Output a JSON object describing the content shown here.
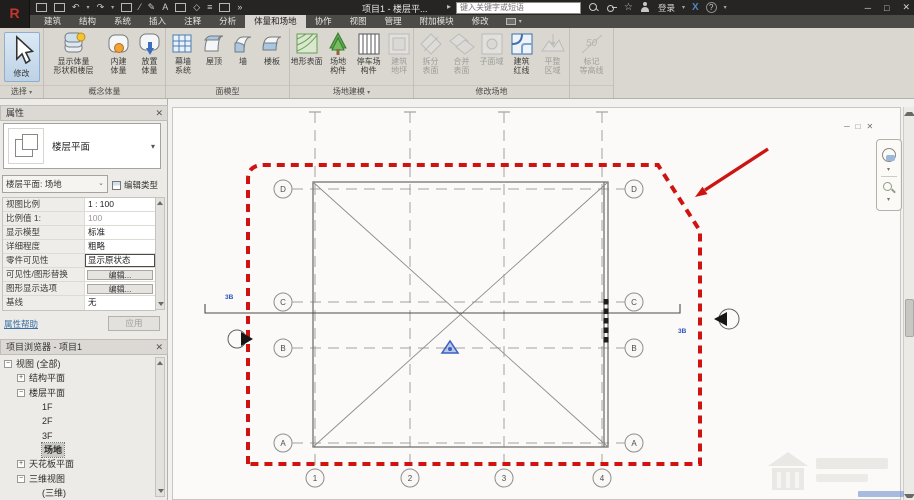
{
  "title_bar": {
    "title": "项目1 - 楼层平...",
    "search_placeholder": "键入关键字或短语",
    "sign_in": "登录",
    "window": {
      "min": "─",
      "max": "□",
      "close": "✕"
    }
  },
  "tabs": [
    {
      "label": "建筑"
    },
    {
      "label": "结构"
    },
    {
      "label": "系统"
    },
    {
      "label": "插入"
    },
    {
      "label": "注释"
    },
    {
      "label": "分析"
    },
    {
      "label": "体量和场地"
    },
    {
      "label": "协作"
    },
    {
      "label": "视图"
    },
    {
      "label": "管理"
    },
    {
      "label": "附加模块"
    },
    {
      "label": "修改"
    }
  ],
  "ribbon": {
    "panels": [
      {
        "label": "选择",
        "buttons": [
          {
            "l1": "修改",
            "l2": ""
          }
        ]
      },
      {
        "label": "概念体量",
        "buttons": [
          {
            "l1": "显示体量",
            "l2": "形状和楼层"
          },
          {
            "l1": "内建",
            "l2": "体量"
          },
          {
            "l1": "放置",
            "l2": "体量"
          }
        ]
      },
      {
        "label": "面模型",
        "buttons": [
          {
            "l1": "幕墙",
            "l2": "系统"
          },
          {
            "l1": "屋顶",
            "l2": ""
          },
          {
            "l1": "墙",
            "l2": ""
          },
          {
            "l1": "楼板",
            "l2": ""
          }
        ]
      },
      {
        "label": "场地建模",
        "buttons": [
          {
            "l1": "地形表面",
            "l2": ""
          },
          {
            "l1": "场地",
            "l2": "构件"
          },
          {
            "l1": "停车场",
            "l2": "构件"
          },
          {
            "l1": "建筑",
            "l2": "地坪"
          }
        ]
      },
      {
        "label": "修改场地",
        "buttons": [
          {
            "l1": "拆分",
            "l2": "表面"
          },
          {
            "l1": "合并",
            "l2": "表面"
          },
          {
            "l1": "子面域",
            "l2": ""
          },
          {
            "l1": "建筑",
            "l2": "红线"
          },
          {
            "l1": "平整",
            "l2": "区域"
          }
        ]
      },
      {
        "label": "",
        "buttons": [
          {
            "l1": "标记",
            "l2": "等高线"
          }
        ]
      }
    ]
  },
  "properties": {
    "header": "属性",
    "type_selector": "楼层平面",
    "instance_selector": "楼层平面: 场地",
    "edit_type": "编辑类型",
    "rows": [
      {
        "label": "视图比例",
        "value": "1 : 100"
      },
      {
        "label": "比例值 1:",
        "value": "100"
      },
      {
        "label": "显示模型",
        "value": "标准"
      },
      {
        "label": "详细程度",
        "value": "粗略"
      },
      {
        "label": "零件可见性",
        "value": "显示原状态"
      },
      {
        "label": "可见性/图形替换",
        "value": "编辑..."
      },
      {
        "label": "图形显示选项",
        "value": "编辑..."
      },
      {
        "label": "基线",
        "value": "无"
      }
    ],
    "help_link": "属性帮助",
    "apply_button": "应用"
  },
  "project_browser": {
    "header": "项目浏览器 - 项目1",
    "tree": [
      {
        "label": "视图 (全部)",
        "expander": "−"
      },
      {
        "label": "结构平面",
        "expander": "+"
      },
      {
        "label": "楼层平面",
        "expander": "−"
      },
      {
        "label": "1F"
      },
      {
        "label": "2F"
      },
      {
        "label": "3F"
      },
      {
        "label": "场地"
      },
      {
        "label": "天花板平面",
        "expander": "+"
      },
      {
        "label": "三维视图",
        "expander": "−"
      },
      {
        "label": "(三维)"
      }
    ]
  },
  "canvas": {
    "grid_rows": [
      "D",
      "C",
      "B",
      "A"
    ],
    "grid_cols": [
      "1",
      "2",
      "3",
      "4"
    ],
    "section_tag_left": "3B",
    "section_tag_right": "3B"
  }
}
